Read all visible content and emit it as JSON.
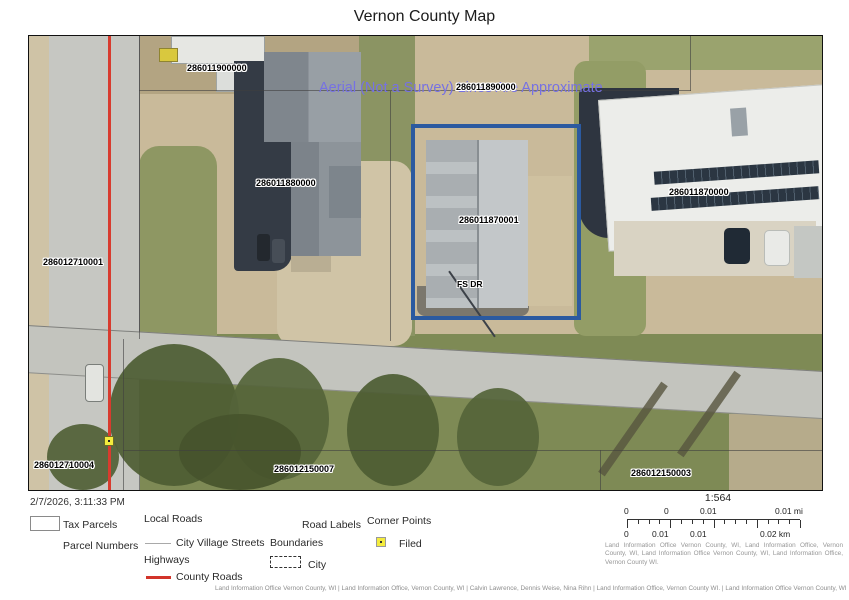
{
  "title": "Vernon County Map",
  "map": {
    "watermark": "Aerial (Not a Survey) Lines Are Approximate",
    "road_label": "FS DR",
    "selected_parcel_id": "286011870001",
    "parcels": [
      {
        "id": "286011900000",
        "x": 158,
        "y": 27
      },
      {
        "id": "286011890000",
        "x": 427,
        "y": 46
      },
      {
        "id": "286011880000",
        "x": 227,
        "y": 142
      },
      {
        "id": "286011870000",
        "x": 640,
        "y": 151
      },
      {
        "id": "286011870001",
        "x": 430,
        "y": 179
      },
      {
        "id": "286012710001",
        "x": 14,
        "y": 221
      },
      {
        "id": "286012710004",
        "x": 5,
        "y": 424
      },
      {
        "id": "286012150007",
        "x": 245,
        "y": 428
      },
      {
        "id": "286012150003",
        "x": 602,
        "y": 432
      }
    ]
  },
  "legend": {
    "timestamp": "2/7/2026, 3:11:33 PM",
    "tax_parcels": "Tax Parcels",
    "parcel_numbers": "Parcel Numbers",
    "local_roads": "Local Roads",
    "city_village_streets": "City Village Streets",
    "highways": "Highways",
    "county_roads": "County Roads",
    "road_labels": "Road Labels",
    "boundaries": "Boundaries",
    "city": "City",
    "corner_points": "Corner Points",
    "filed": "Filed"
  },
  "scalebar": {
    "ratio": "1:564",
    "mi_labels": [
      "0",
      "0",
      "0.01",
      "0.01 mi"
    ],
    "km_labels": [
      "0",
      "0.01",
      "0.01",
      "0.02 km"
    ]
  },
  "attribution": {
    "scale_block": "Land Information Office Vernon County, WI, Land Information Office, Vernon County, WI, Land Information Office Vernon County, WI, Land Information Office, Vernon County WI.",
    "footer": "Land Information Office Vernon County, WI | Land Information Office, Vernon County, WI | Calvin Lawrence, Dennis Weise, Nina Rihn | Land Information Office, Vernon County WI. | Land Information Office Vernon County, WI. |"
  },
  "colors": {
    "selected_parcel_outline": "#2b5aa0",
    "county_road_red": "#d83b2e",
    "watermark_purple": "#7671e3",
    "corner_point_yellow": "#f4ec3d"
  }
}
